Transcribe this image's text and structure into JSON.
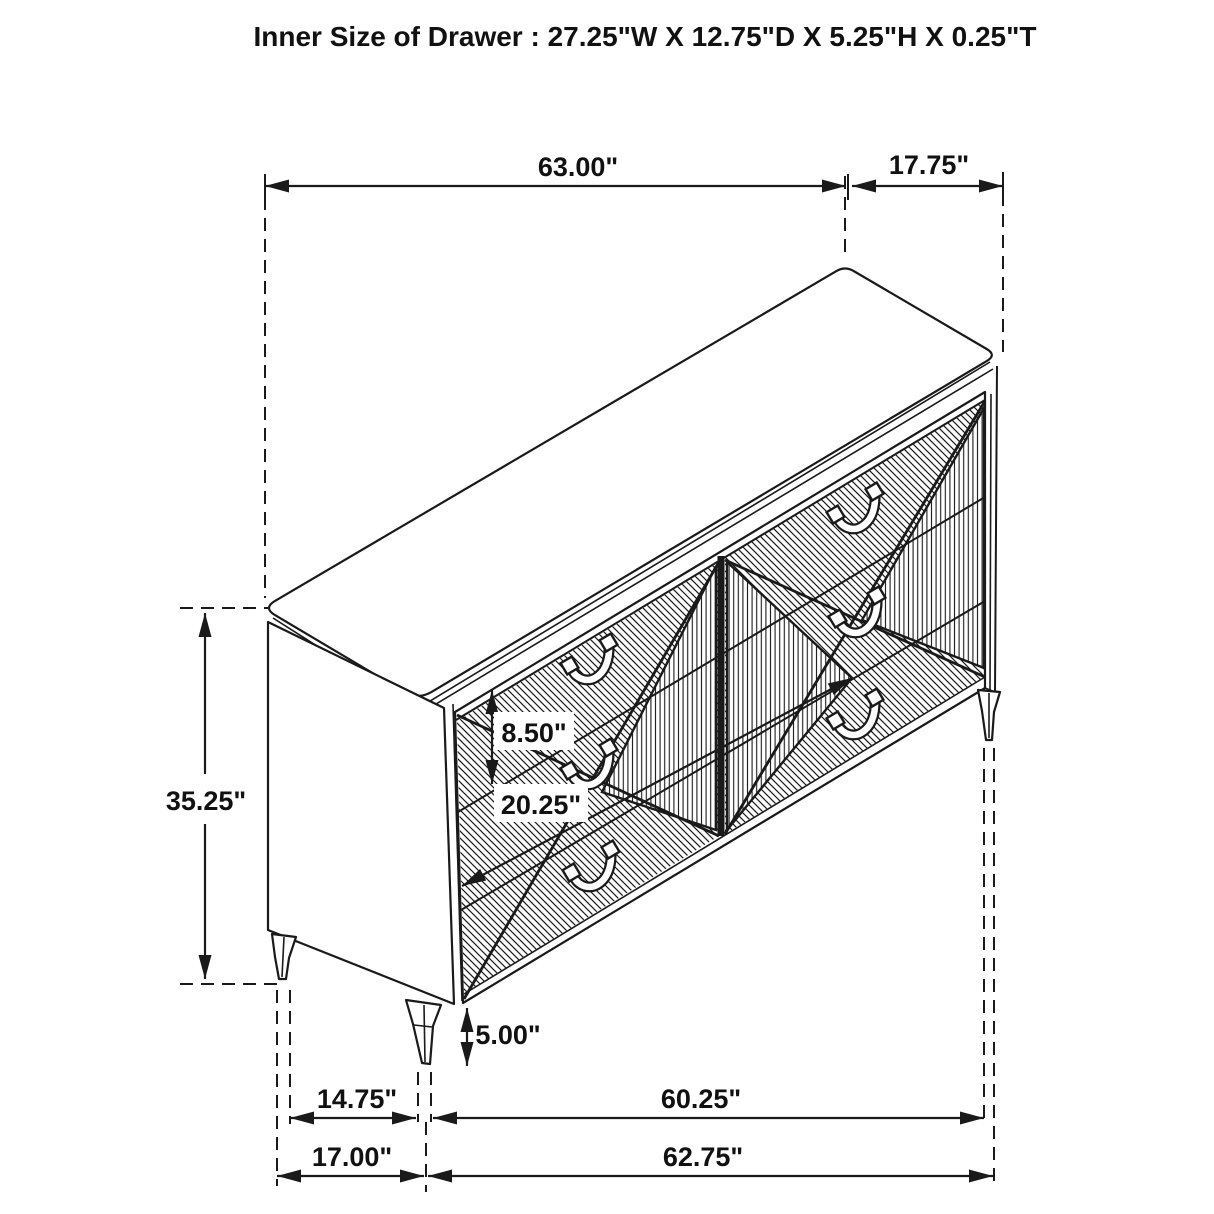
{
  "title": "Inner Size of Drawer : 27.25\"W X 12.75\"D X 5.25\"H X 0.25\"T",
  "diagram": {
    "type": "furniture-dimension-drawing",
    "object": "6-drawer dresser, isometric line art with hatched drawer fronts"
  },
  "dims": {
    "top_width": "63.00\"",
    "top_depth": "17.75\"",
    "overall_height": "35.25\"",
    "drawer_face_height": "8.50\"",
    "drawer_face_width": "20.25\"",
    "leg_height": "5.00\"",
    "side_leg_span": "14.75\"",
    "front_leg_span": "60.25\"",
    "side_base": "17.00\"",
    "front_base": "62.75\""
  },
  "colors": {
    "line": "#1a1a1a",
    "background": "#ffffff"
  }
}
